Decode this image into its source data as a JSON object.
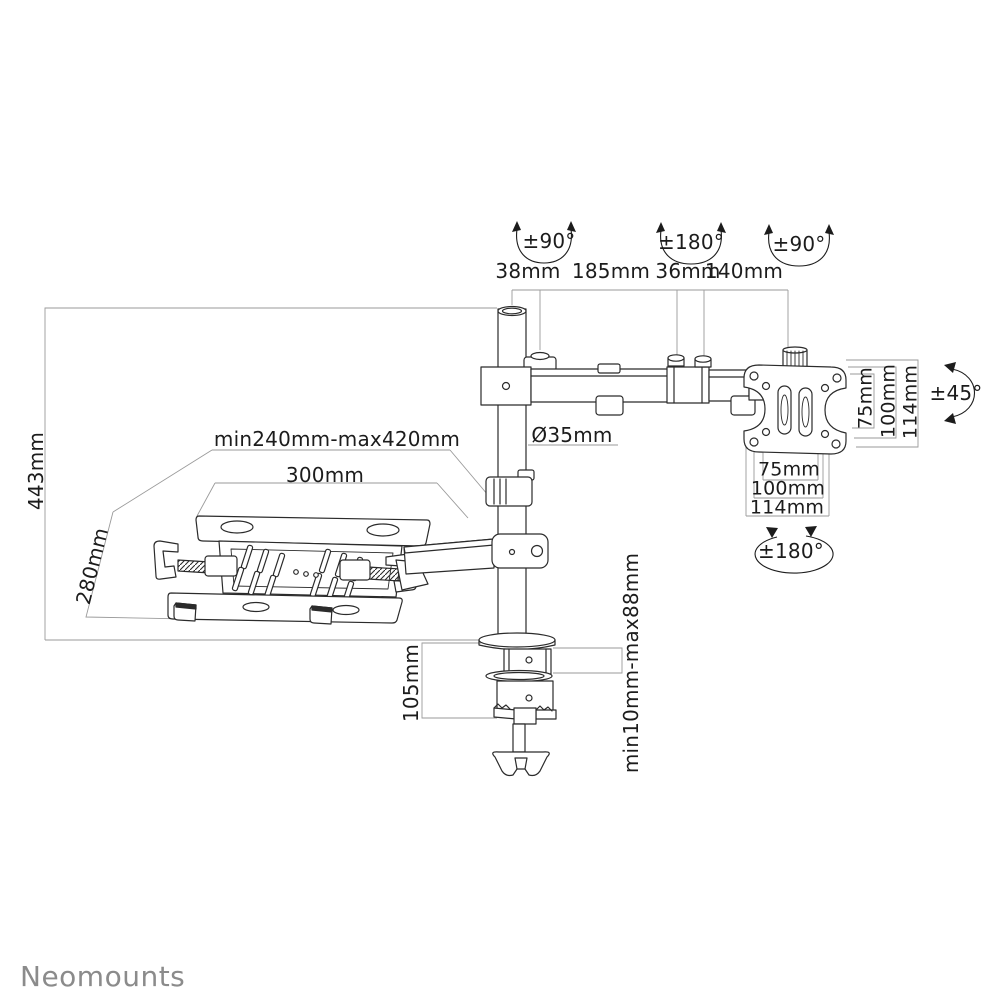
{
  "page": {
    "background": "#ffffff"
  },
  "brand": {
    "logo": "Neomounts"
  },
  "labels": {
    "rot_pole": "±90°",
    "rot_elbow": "±180°",
    "rot_vesa": "±90°",
    "dim_38": "38mm",
    "dim_185": "185mm",
    "dim_36": "36mm",
    "dim_140": "140mm",
    "pole_height": "443mm",
    "pole_diameter": "Ø35mm",
    "tray_range": "min240mm-max420mm",
    "tray_width": "300mm",
    "tray_depth": "280mm",
    "vesa_w_75": "75mm",
    "vesa_w_100": "100mm",
    "vesa_w_114": "114mm",
    "vesa_h_75": "75mm",
    "vesa_h_100": "100mm",
    "vesa_h_114": "114mm",
    "vesa_tilt": "±45°",
    "vesa_rotation": "±180°",
    "clamp_height": "105mm",
    "desk_thickness": "min10mm-max88mm"
  },
  "colors": {
    "line": "#2b2b2b",
    "dimension_line": "#9a9a9a",
    "logo": "#8b8b8b"
  }
}
